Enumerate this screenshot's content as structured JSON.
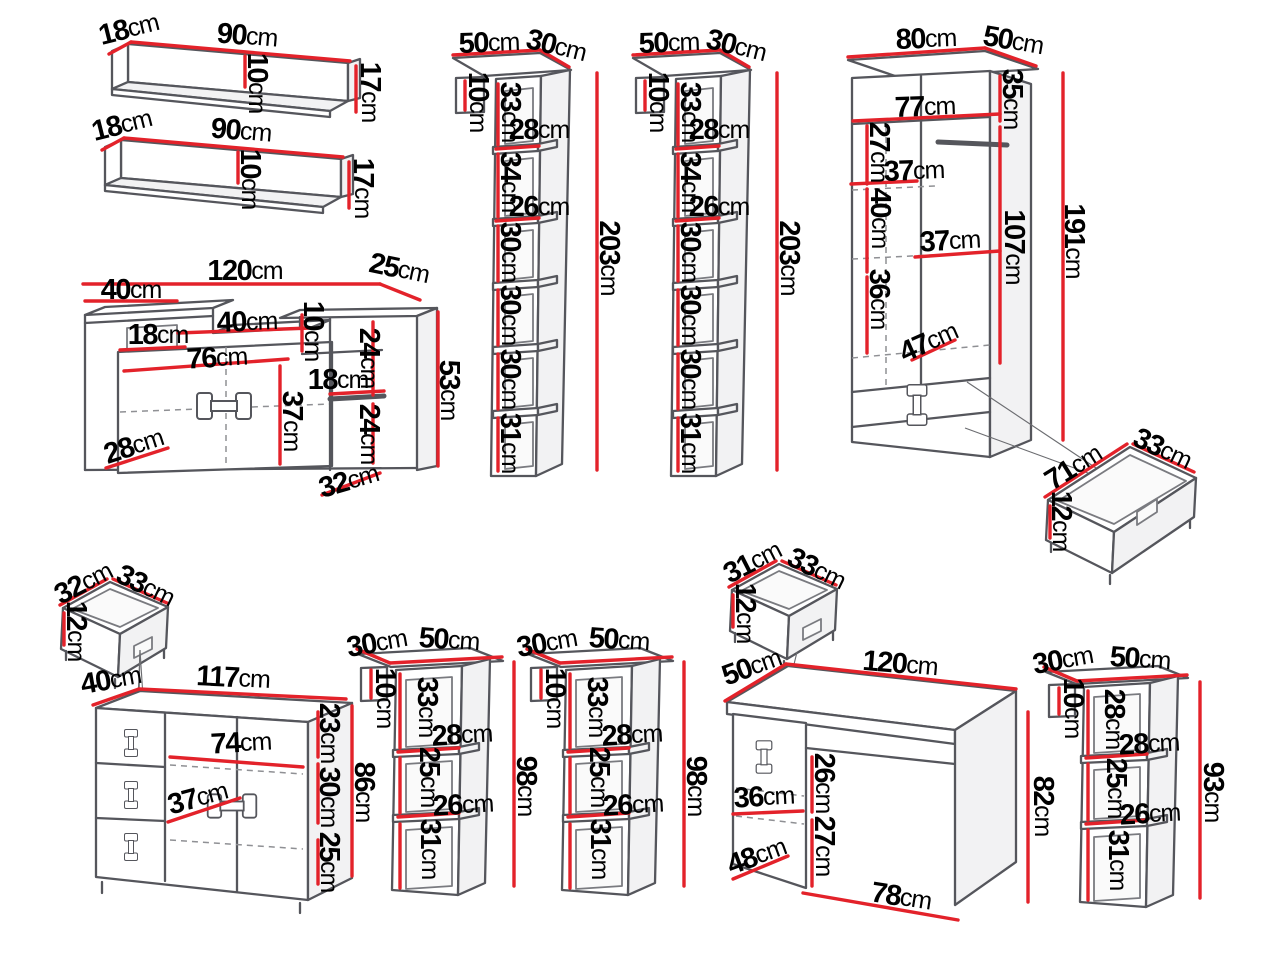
{
  "colors": {
    "dimension_line": "#e3222a",
    "outline": "#55565c",
    "label_text": "#000000",
    "background": "#ffffff"
  },
  "pieces": {
    "wall_shelf_a": {
      "depth": "18cm",
      "width": "90cm",
      "back_height": "10cm",
      "height": "17cm"
    },
    "wall_shelf_b": {
      "depth": "18cm",
      "width": "90cm",
      "back_height": "10cm",
      "height": "17cm"
    },
    "tv_stand": {
      "width": "120cm",
      "depth": "25cm",
      "left_shelf_width": "40cm",
      "left_opening_width": "18cm",
      "middle_shelf_width": "40cm",
      "right_top_height": "10cm",
      "right_upper_height": "24cm",
      "cabinet_width": "76cm",
      "right_shelf_width": "18cm",
      "cabinet_height": "37cm",
      "right_lower_height": "24cm",
      "bottom_left_depth": "28cm",
      "bottom_right_depth": "32cm",
      "height": "53cm"
    },
    "bookcase_a": {
      "width": "50cm",
      "depth": "30cm",
      "top_side_height": "10cm",
      "section1_height": "33cm",
      "shelf1_width": "28cm",
      "section2_height": "34cm",
      "shelf2_width": "26cm",
      "section3_height": "30cm",
      "section4_height": "30cm",
      "section5_height": "30cm",
      "section6_height": "31cm",
      "height": "203cm"
    },
    "bookcase_b": {
      "width": "50cm",
      "depth": "30cm",
      "top_side_height": "10cm",
      "section1_height": "33cm",
      "shelf1_width": "28cm",
      "section2_height": "34cm",
      "shelf2_width": "26cm",
      "section3_height": "30cm",
      "section4_height": "30cm",
      "section5_height": "30cm",
      "section6_height": "31cm",
      "height": "203cm"
    },
    "wardrobe": {
      "width": "80cm",
      "depth": "50cm",
      "top_section_height": "35cm",
      "inner_width": "77cm",
      "upper_section_height": "27cm",
      "shelf_width_1": "37cm",
      "middle_section_height": "40cm",
      "shelf_width_2": "37cm",
      "hanging_height": "107cm",
      "lower_section_height": "36cm",
      "inner_depth": "47cm",
      "height": "191cm"
    },
    "drawer_wide": {
      "width": "71cm",
      "depth": "33cm",
      "height": "12cm"
    },
    "drawer_small_left": {
      "width": "32cm",
      "depth": "33cm",
      "height": "12cm"
    },
    "drawer_small_middle": {
      "width": "31cm",
      "depth": "33cm",
      "height": "12cm"
    },
    "dresser": {
      "depth": "40cm",
      "width": "117cm",
      "top_section_height": "23cm",
      "inner_width": "74cm",
      "middle_section_height": "30cm",
      "shelf_depth": "37cm",
      "bottom_section_height": "25cm",
      "height": "86cm"
    },
    "shelf_unit_a": {
      "depth": "30cm",
      "width": "50cm",
      "top_side_height": "10cm",
      "section1_height": "33cm",
      "shelf1_width": "28cm",
      "section2_height": "25cm",
      "shelf2_width": "26cm",
      "section3_height": "31cm",
      "height": "98cm"
    },
    "shelf_unit_b": {
      "depth": "30cm",
      "width": "50cm",
      "top_side_height": "10cm",
      "section1_height": "33cm",
      "shelf1_width": "28cm",
      "section2_height": "25cm",
      "shelf2_width": "26cm",
      "section3_height": "31cm",
      "height": "98cm"
    },
    "shelf_unit_c": {
      "depth": "30cm",
      "width": "50cm",
      "top_side_height": "10cm",
      "section1_height": "28cm",
      "shelf1_width": "28cm",
      "section2_height": "25cm",
      "shelf2_width": "26cm",
      "section3_height": "31cm",
      "height": "93cm"
    },
    "desk": {
      "depth": "50cm",
      "width": "120cm",
      "cabinet_shelf_width": "36cm",
      "upper_section_height": "26cm",
      "lower_section_height": "27cm",
      "cabinet_depth": "48cm",
      "bottom_width": "78cm",
      "height": "82cm"
    }
  }
}
